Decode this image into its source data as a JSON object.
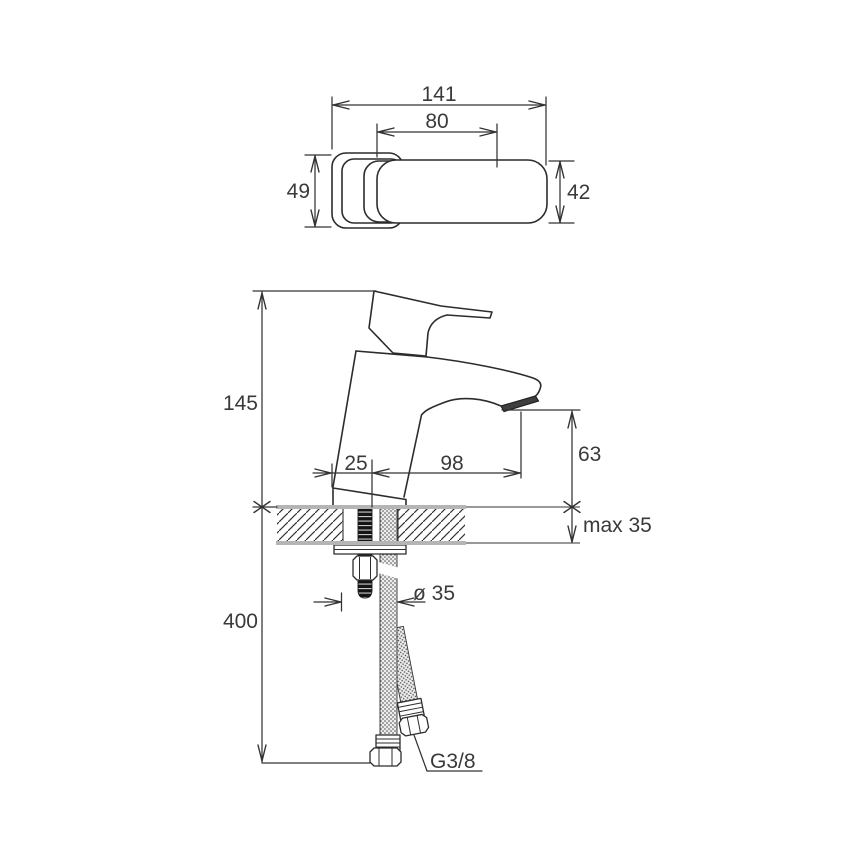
{
  "drawing": {
    "kind": "faucet installation dimension drawing",
    "views": {
      "top": "top view",
      "side": "side view with countertop section"
    }
  },
  "dims": {
    "top_width": "141",
    "top_handle": "80",
    "top_depth_left": "49",
    "top_depth_right": "42",
    "height_above_deck": "145",
    "base_offset": "25",
    "spout_reach": "98",
    "spout_height": "63",
    "deck_thickness": "max 35",
    "hose_drop": "400",
    "hole_diameter": "ø 35",
    "hose_thread": "G3/8"
  },
  "colors": {
    "line": "#2c2c2c",
    "text": "#3a3a3a",
    "deck_gray": "#b5b5b5",
    "aerator": "#3f3f3f"
  }
}
